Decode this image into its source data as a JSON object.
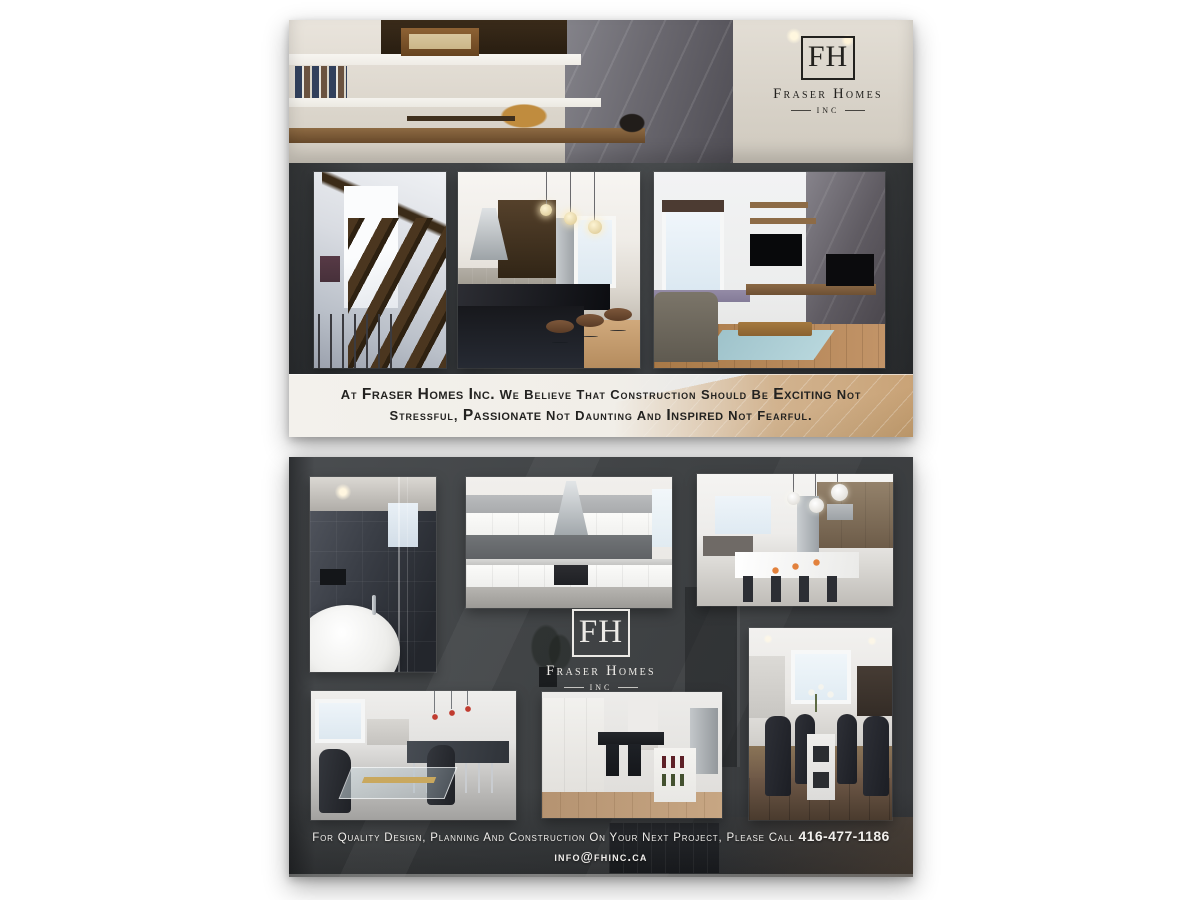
{
  "brand": {
    "monogram": "FH",
    "name": "Fraser Homes",
    "suffix": "INC"
  },
  "front": {
    "tagline_segments": [
      {
        "t": "At ",
        "b": false
      },
      {
        "t": "Fraser Homes Inc.",
        "b": true
      },
      {
        "t": " We Believe That Construction Should Be ",
        "b": false
      },
      {
        "t": "Exciting",
        "b": true
      },
      {
        "t": " Not",
        "b": false
      },
      {
        "br": true
      },
      {
        "t": "Stressful, ",
        "b": false
      },
      {
        "t": "Passionate",
        "b": true
      },
      {
        "t": " Not Daunting And ",
        "b": false
      },
      {
        "t": "Inspired",
        "b": true
      },
      {
        "t": " Not Fearful.",
        "b": false
      }
    ],
    "photos": {
      "hero": "Living room built-in shelves with vintage radio and electric guitar",
      "staircase": "Open-riser wood staircase with glass railing",
      "kitchen_bar": "Kitchen with granite island, pendant lights and bar stools",
      "living_room": "Living room with marble fireplace wall, TV and area rug"
    }
  },
  "back": {
    "footer_segments": [
      {
        "t": "For Quality Design, Planning And Construction On Your Next Project, Please Call ",
        "b": false
      },
      {
        "t": "416-477-1186",
        "b": true
      }
    ],
    "email": "info@fhinc.ca",
    "photos": {
      "bathroom": "Dark-tile bathroom with freestanding tub and glass shower",
      "kitchen_white": "White kitchen with stainless range hood",
      "kitchen_pendants": "Kitchen with breakfast island and globe pendants",
      "dining_glass": "Glass dining table beside kitchen island",
      "kitchen_wine": "Kitchen island with wine shelf and stainless fridge",
      "dining_chairs": "Dining table with dark leather chairs"
    }
  },
  "colors": {
    "charcoal": "#3a3d3f",
    "band": "#f1eee8",
    "logo_dark": "#22211e",
    "logo_light": "#eceae6",
    "wood_accent": "#c79f71"
  }
}
